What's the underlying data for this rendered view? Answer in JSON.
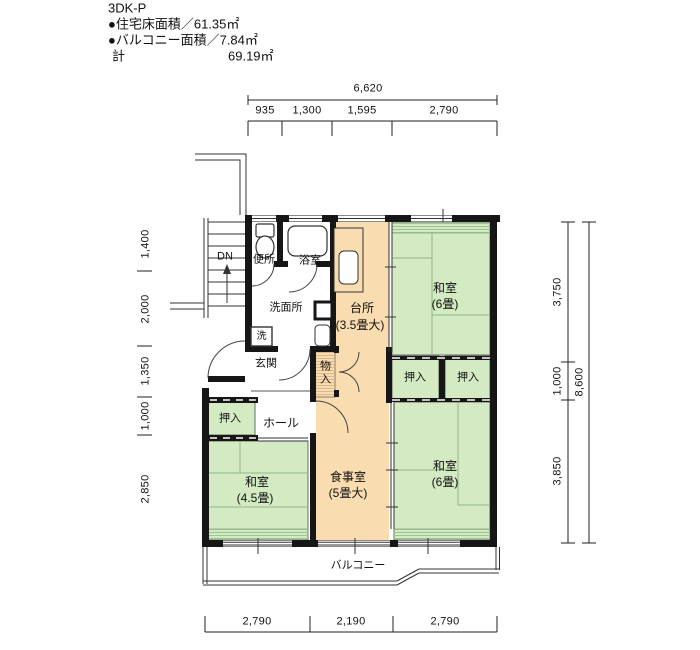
{
  "header": {
    "plan_type": "3DK-P",
    "floor_area_line": "●住宅床面積／61.35㎡",
    "balcony_area_line": "●バルコニー面積／7.84㎡",
    "total_label": "計",
    "total_value": "69.19㎡"
  },
  "dimensions": {
    "top": {
      "overall": "6,620",
      "segments": [
        "935",
        "1,300",
        "1,595",
        "2,790"
      ]
    },
    "left": {
      "segments": [
        "1,400",
        "2,000",
        "1,350",
        "1,000",
        "2,850"
      ]
    },
    "right": {
      "segments": [
        "3,750",
        "1,000",
        "3,850"
      ],
      "overall": "8,600"
    },
    "bottom": {
      "segments": [
        "2,790",
        "2,190",
        "2,790"
      ]
    }
  },
  "rooms": {
    "toilet": "便所",
    "bath": "浴室",
    "washroom": "洗面所",
    "laundry": "洗",
    "kitchen": {
      "name": "台所",
      "size": "(3.5畳大)"
    },
    "tatami_ne": {
      "name": "和室",
      "size": "(6畳)"
    },
    "tatami_se": {
      "name": "和室",
      "size": "(6畳)"
    },
    "tatami_sw": {
      "name": "和室",
      "size": "(4.5畳)"
    },
    "dining": {
      "name": "食事室",
      "size": "(5畳大)"
    },
    "entrance": "玄関",
    "hall": "ホール",
    "closet_sw": "押入",
    "closet_e1": "押入",
    "closet_e2": "押入",
    "storage": "物入",
    "balcony": "バルコニー",
    "stairs_down": "DN"
  },
  "colors": {
    "tatami": "#d3eac3",
    "flooring": "#f9dcb0",
    "wall": "#161616",
    "tatami_hatch": "#9cc494",
    "flooring_hatch": "#d8b88a",
    "line": "#333333"
  }
}
